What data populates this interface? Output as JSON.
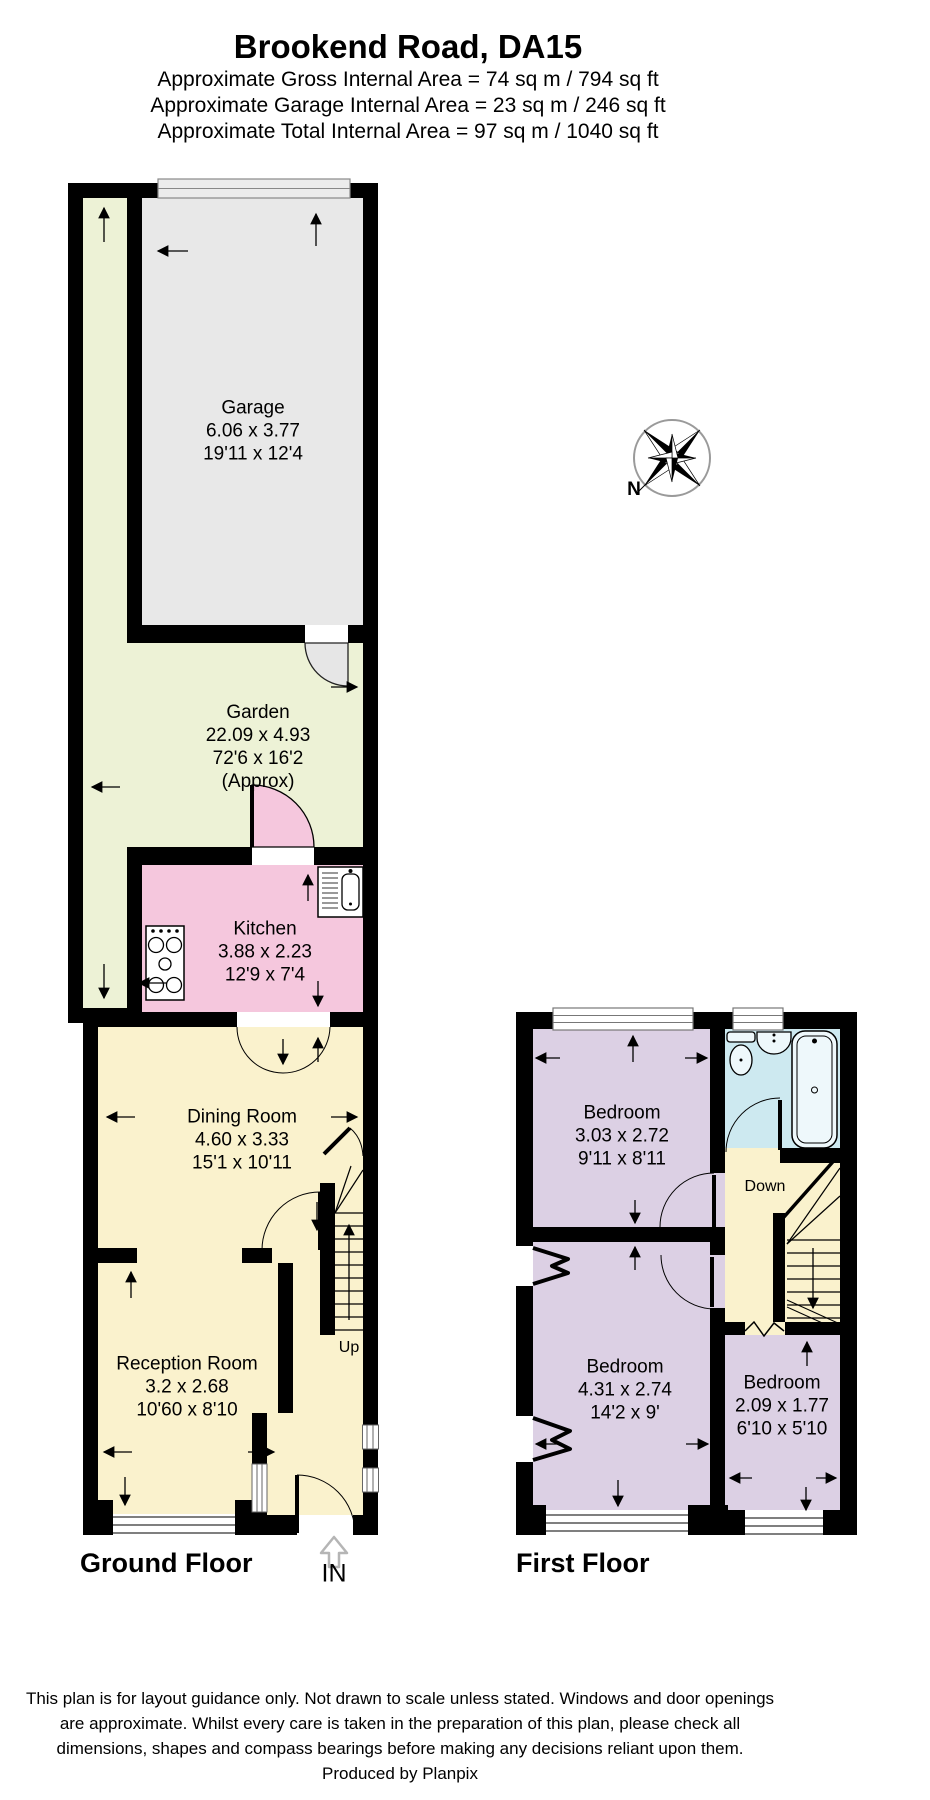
{
  "header": {
    "title": "Brookend Road, DA15",
    "line1": "Approximate Gross Internal Area = 74 sq m / 794 sq ft",
    "line2": "Approximate Garage Internal Area = 23 sq m / 246 sq ft",
    "line3": "Approximate Total Internal Area = 97 sq m / 1040 sq ft"
  },
  "floors": {
    "ground": {
      "label": "Ground Floor"
    },
    "first": {
      "label": "First Floor"
    }
  },
  "rooms": {
    "garage": {
      "name": "Garage",
      "metric": "6.06 x 3.77",
      "imperial": "19'11 x 12'4"
    },
    "garden": {
      "name": "Garden",
      "metric": "22.09 x 4.93",
      "imperial": "72'6 x 16'2",
      "note": "(Approx)"
    },
    "kitchen": {
      "name": "Kitchen",
      "metric": "3.88 x 2.23",
      "imperial": "12'9 x 7'4"
    },
    "dining": {
      "name": "Dining Room",
      "metric": "4.60 x 3.33",
      "imperial": "15'1 x 10'11"
    },
    "reception": {
      "name": "Reception Room",
      "metric": "3.2 x 2.68",
      "imperial": "10'60 x 8'10"
    },
    "bedroom1": {
      "name": "Bedroom",
      "metric": "3.03 x 2.72",
      "imperial": "9'11 x 8'11"
    },
    "bedroom2": {
      "name": "Bedroom",
      "metric": "4.31 x 2.74",
      "imperial": "14'2 x 9'"
    },
    "bedroom3": {
      "name": "Bedroom",
      "metric": "2.09 x 1.77",
      "imperial": "6'10 x 5'10"
    }
  },
  "annotations": {
    "up": "Up",
    "down": "Down",
    "entrance": "IN",
    "north": "N"
  },
  "footer": {
    "line1": "This plan is for layout guidance only. Not drawn to scale unless stated. Windows and door openings",
    "line2": "are approximate. Whilst every care is taken in the preparation of this plan, please check all",
    "line3": "dimensions, shapes and compass bearings before making any decisions reliant upon them.",
    "line4": "Produced by Planpix"
  },
  "colors": {
    "garden": "#edf2d6",
    "garage": "#e8e8e8",
    "kitchen": "#f5c7dd",
    "living": "#faf2cd",
    "bedroom": "#dcd0e4",
    "bathroom": "#cde9f0",
    "wall": "#000000"
  }
}
